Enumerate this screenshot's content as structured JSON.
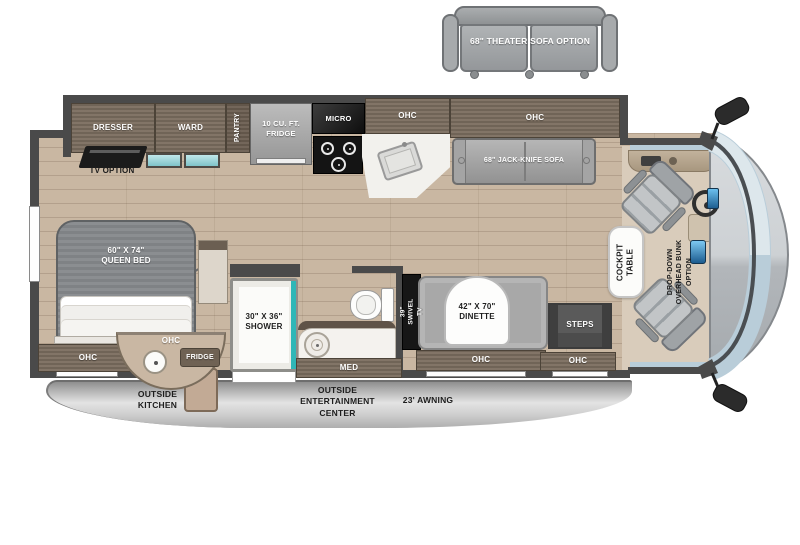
{
  "floorplan": {
    "theater_sofa_option": "68\" THEATER SOFA OPTION",
    "bedroom": {
      "dresser": "DRESSER",
      "ward": "WARD",
      "pantry": "PANTRY",
      "tv_option": "TV OPTION",
      "queen_bed": "60\" x 74\"\nQUEEN BED",
      "ohc": "OHC"
    },
    "kitchen": {
      "fridge": "10 CU. FT.\nFRIDGE",
      "micro": "MICRO",
      "ohc": "OHC"
    },
    "living": {
      "sofa_ohc": "OHC",
      "jack_knife_sofa": "68\" JACK-KNIFE SOFA",
      "swivel_tv": "39\" SWIVEL TV",
      "dinette": "42\" x 70\"\nDINETTE",
      "dinette_ohc": "OHC"
    },
    "bathroom": {
      "shower": "30\" x 36\"\nSHOWER",
      "med": "MED"
    },
    "entry": {
      "steps": "STEPS",
      "ohc": "OHC"
    },
    "cockpit": {
      "table": "COCKPIT\nTABLE",
      "bunk_option": "DROP-DOWN\nOVERHEAD BUNK\nOPTION"
    },
    "exterior": {
      "outside_kitchen_ohc": "OHC",
      "outside_kitchen_fridge": "FRIDGE",
      "outside_kitchen": "OUTSIDE\nKITCHEN",
      "entertainment_center": "OUTSIDE\nENTERTAINMENT\nCENTER",
      "awning": "23' AWNING"
    },
    "colors": {
      "wood_floor": "#c9b7a2",
      "cabinet_wood": "#7a6c5e",
      "accent_teal": "#7fc3c8",
      "appliance_gray": "#a8a8a8",
      "windshield_blue": "#b9cdd9",
      "awning_band_gray": "#c9c9c9"
    }
  }
}
